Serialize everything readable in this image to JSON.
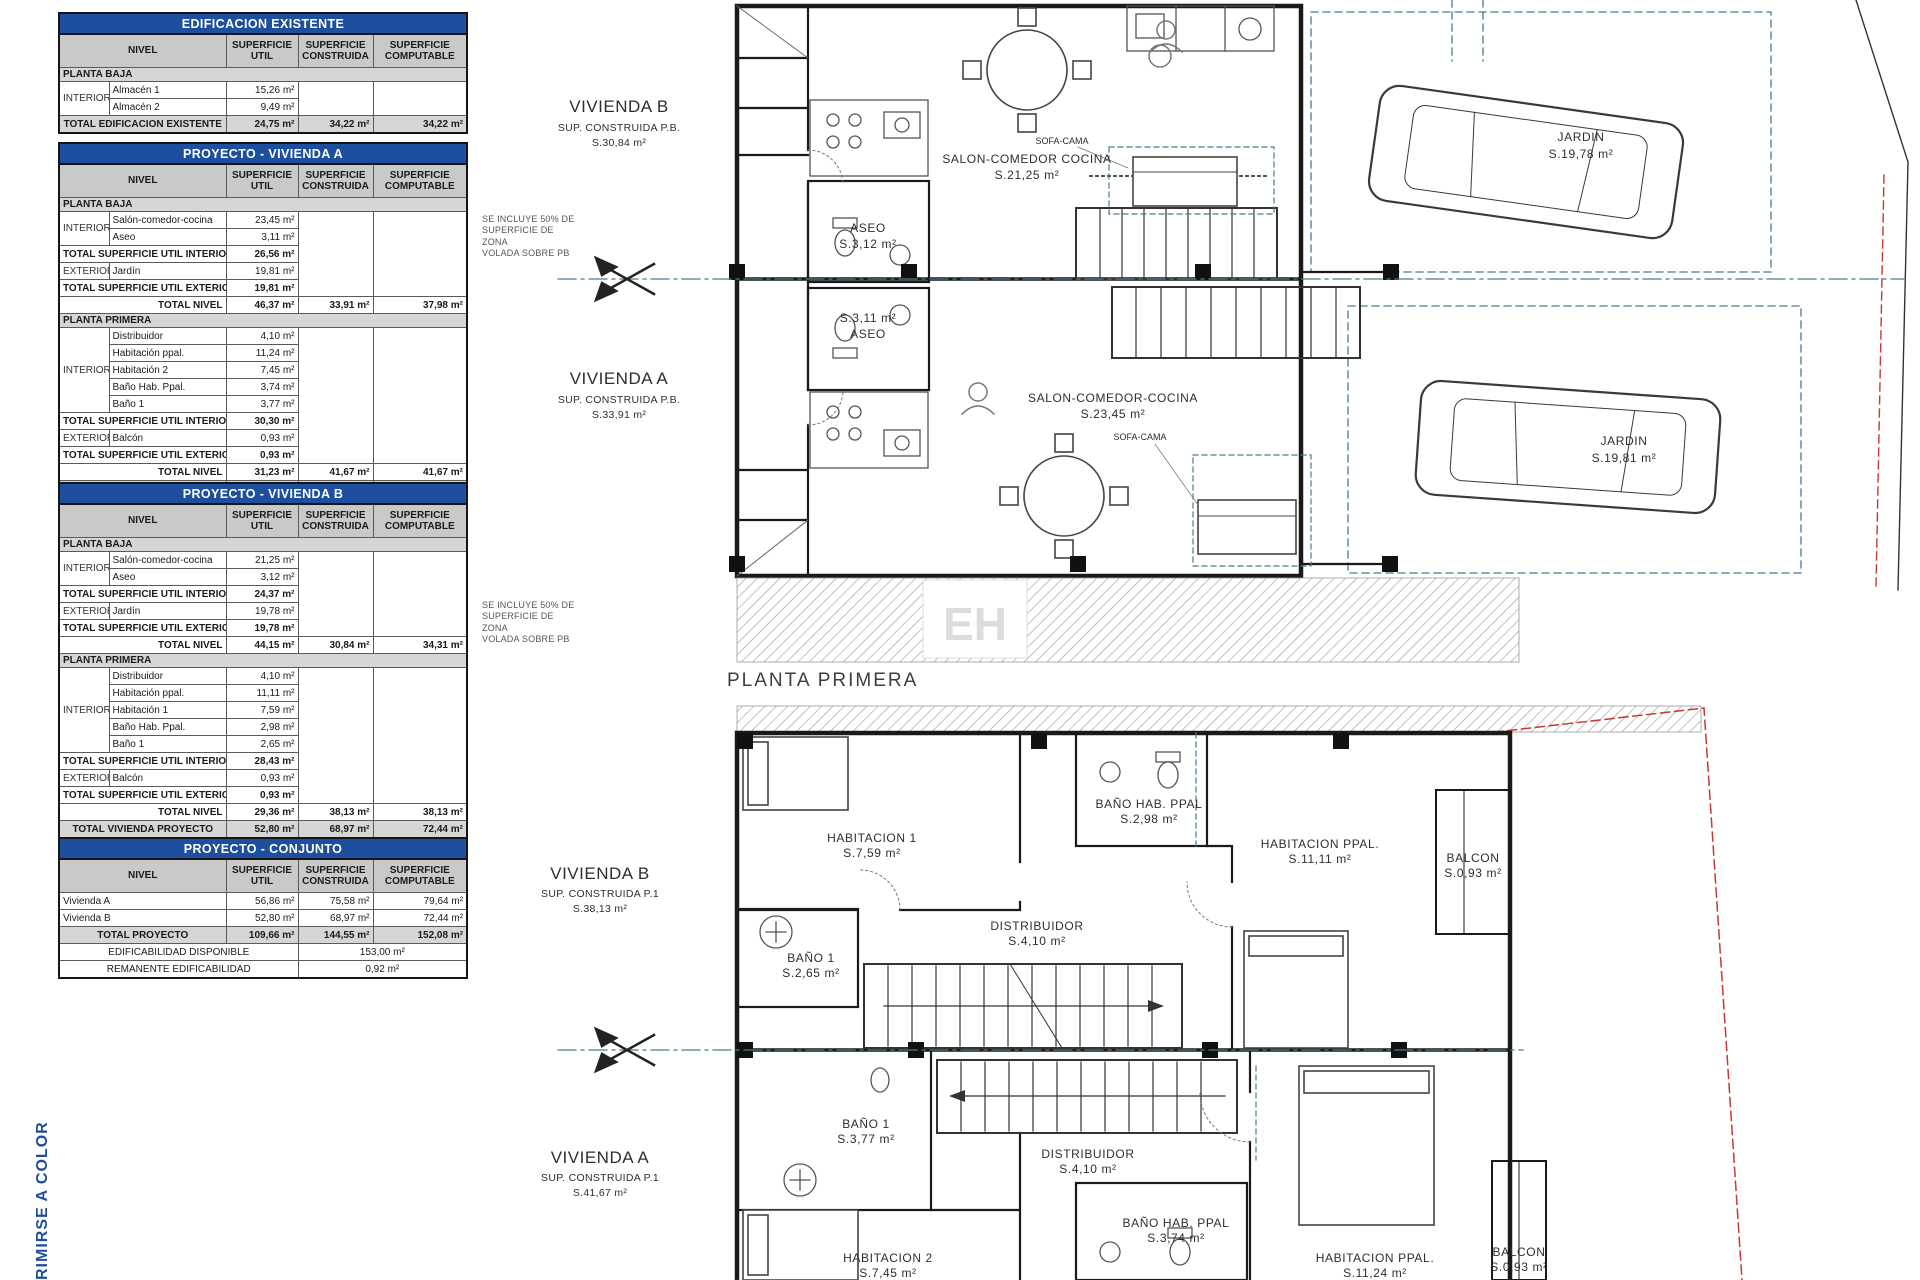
{
  "labels": {
    "nivel": "NIVEL",
    "sup_util": "SUPERFICIE UTIL",
    "sup_constr": "SUPERFICIE CONSTRUIDA",
    "sup_comp": "SUPERFICIE COMPUTABLE",
    "planta_baja": "PLANTA BAJA",
    "planta_primera": "PLANTA PRIMERA",
    "interior": "INTERIOR",
    "exterior": "EXTERIOR",
    "tot_util_int": "TOTAL SUPERFICIE UTIL INTERIOR",
    "tot_util_ext": "TOTAL SUPERFICIE UTIL EXTERIOR",
    "total_nivel": "TOTAL NIVEL"
  },
  "t_exist": {
    "title": "EDIFICACION EXISTENTE",
    "rooms": [
      {
        "n": "Almacén 1",
        "v": "15,26 m²"
      },
      {
        "n": "Almacén 2",
        "v": "9,49 m²"
      }
    ],
    "total": {
      "label": "TOTAL EDIFICACION EXISTENTE",
      "u": "24,75 m²",
      "c": "34,22 m²",
      "m": "34,22 m²"
    }
  },
  "t_va": {
    "title": "PROYECTO - VIVIENDA A",
    "pb": {
      "rooms": [
        {
          "n": "Salón-comedor-cocina",
          "v": "23,45 m²"
        },
        {
          "n": "Aseo",
          "v": "3,11 m²"
        }
      ],
      "tot_int": "26,56 m²",
      "ext": {
        "n": "Jardín",
        "v": "19,81 m²"
      },
      "tot_ext": "19,81 m²",
      "nivel": {
        "u": "46,37 m²",
        "c": "33,91 m²",
        "m": "37,98 m²"
      }
    },
    "p1": {
      "rooms": [
        {
          "n": "Distribuidor",
          "v": "4,10 m²"
        },
        {
          "n": "Habitación ppal.",
          "v": "11,24 m²"
        },
        {
          "n": "Habitación 2",
          "v": "7,45 m²"
        },
        {
          "n": "Baño Hab. Ppal.",
          "v": "3,74 m²"
        },
        {
          "n": "Baño 1",
          "v": "3,77 m²"
        }
      ],
      "tot_int": "30,30 m²",
      "ext": {
        "n": "Balcón",
        "v": "0,93 m²"
      },
      "tot_ext": "0,93 m²",
      "nivel": {
        "u": "31,23 m²",
        "c": "41,67 m²",
        "m": "41,67 m²"
      }
    },
    "total": {
      "label": "TOTAL VIVIENDA PROYECTO",
      "u": "56,86 m²",
      "c": "75,58 m²",
      "m": "79,64 m²"
    }
  },
  "t_vb": {
    "title": "PROYECTO - VIVIENDA B",
    "pb": {
      "rooms": [
        {
          "n": "Salón-comedor-cocina",
          "v": "21,25 m²"
        },
        {
          "n": "Aseo",
          "v": "3,12 m²"
        }
      ],
      "tot_int": "24,37 m²",
      "ext": {
        "n": "Jardín",
        "v": "19,78 m²"
      },
      "tot_ext": "19,78 m²",
      "nivel": {
        "u": "44,15 m²",
        "c": "30,84 m²",
        "m": "34,31 m²"
      }
    },
    "p1": {
      "rooms": [
        {
          "n": "Distribuidor",
          "v": "4,10 m²"
        },
        {
          "n": "Habitación ppal.",
          "v": "11,11 m²"
        },
        {
          "n": "Habitación 1",
          "v": "7,59 m²"
        },
        {
          "n": "Baño Hab. Ppal.",
          "v": "2,98 m²"
        },
        {
          "n": "Baño 1",
          "v": "2,65 m²"
        }
      ],
      "tot_int": "28,43 m²",
      "ext": {
        "n": "Balcón",
        "v": "0,93 m²"
      },
      "tot_ext": "0,93 m²",
      "nivel": {
        "u": "29,36 m²",
        "c": "38,13 m²",
        "m": "38,13 m²"
      }
    },
    "total": {
      "label": "TOTAL VIVIENDA PROYECTO",
      "u": "52,80 m²",
      "c": "68,97 m²",
      "m": "72,44 m²"
    }
  },
  "t_conj": {
    "title": "PROYECTO - CONJUNTO",
    "rows": [
      {
        "n": "Vivienda A",
        "u": "56,86 m²",
        "c": "75,58 m²",
        "m": "79,64 m²"
      },
      {
        "n": "Vivienda B",
        "u": "52,80 m²",
        "c": "68,97 m²",
        "m": "72,44 m²"
      }
    ],
    "total": {
      "label": "TOTAL PROYECTO",
      "u": "109,66 m²",
      "c": "144,55 m²",
      "m": "152,08 m²"
    },
    "edificabilidad": {
      "label": "EDIFICABILIDAD DISPONIBLE",
      "v": "153,00 m²"
    },
    "remanente": {
      "label": "REMANENTE EDIFICABILIDAD",
      "v": "0,92 m²"
    }
  },
  "notes": {
    "zona_volada": "SE INCLUYE 50% DE\nSUPERFICIE DE ZONA\nVOLADA SOBRE PB"
  },
  "plan_ground": {
    "b_title": "VIVIENDA B",
    "b_sub": "SUP. CONSTRUIDA P.B.",
    "b_area": "S.30,84 m²",
    "a_title": "VIVIENDA A",
    "a_sub": "SUP. CONSTRUIDA P.B.",
    "a_area": "S.33,91 m²",
    "salon_b": "SALON-COMEDOR COCINA",
    "salon_b_area": "S.21,25 m²",
    "aseo_b": "ASEO",
    "aseo_b_area": "S.3,12 m²",
    "aseo_a": "ASEO",
    "aseo_a_area": "S.3,11 m²",
    "salon_a": "SALON-COMEDOR-COCINA",
    "salon_a_area": "S.23,45 m²",
    "sofa_cama": "SOFA-CAMA",
    "jardin": "JARDIN",
    "jardin_b_area": "S.19,78 m²",
    "jardin_a_area": "S.19,81 m²"
  },
  "plan_first": {
    "title": "PLANTA PRIMERA",
    "b_title": "VIVIENDA B",
    "b_sub": "SUP. CONSTRUIDA P.1",
    "b_area": "S.38,13 m²",
    "a_title": "VIVIENDA A",
    "a_sub": "SUP. CONSTRUIDA P.1",
    "a_area": "S.41,67 m²",
    "hab1": "HABITACION 1",
    "hab1_area": "S.7,59 m²",
    "bano_hp": "BAÑO HAB. PPAL",
    "bano_hp_b_area": "S.2,98 m²",
    "bano_hp_a_area": "S.3,74 m²",
    "habppal": "HABITACION PPAL.",
    "habppal_b_area": "S.11,11 m²",
    "habppal_a_area": "S.11,24 m²",
    "balcon": "BALCON",
    "balcon_area": "S.0,93 m²",
    "distribuidor": "DISTRIBUIDOR",
    "distribuidor_area": "S.4,10 m²",
    "bano1": "BAÑO 1",
    "bano1_b_area": "S.2,65 m²",
    "bano1_a_area": "S.3,77 m²",
    "hab2": "HABITACION 2",
    "hab2_area": "S.7,45 m²"
  },
  "watermark": {
    "text": "EH"
  },
  "footer": {
    "vertical_note": "RIMIRSE A COLOR"
  }
}
